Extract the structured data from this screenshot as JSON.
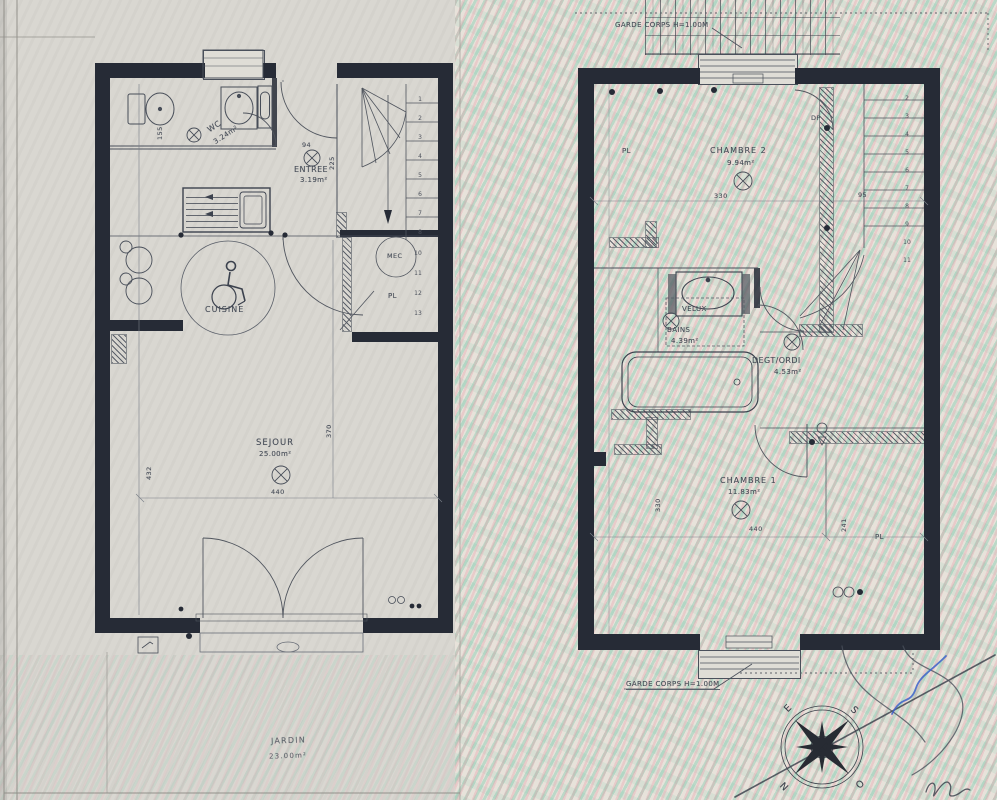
{
  "ground_floor": {
    "labels": {
      "wc": "WC",
      "wc_area": "3.24m²",
      "entree": "ENTREE",
      "entree_area": "3.19m²",
      "cuisine": "CUISINE",
      "sejour": "SEJOUR",
      "sejour_area": "25.00m²",
      "jardin": "JARDIN",
      "jardin_area": "23.00m²",
      "closet": "PL",
      "mec": "MEC"
    },
    "dimensions": {
      "width": "440",
      "depth": "432",
      "sejour_depth": "370",
      "entry_width": "94",
      "entry_depth": "225",
      "wc_width": "155"
    },
    "stair_numbers_upper": [
      "1",
      "2",
      "3",
      "4",
      "5",
      "6",
      "7",
      "8"
    ],
    "stair_numbers_lower": [
      "10",
      "11",
      "12",
      "13"
    ]
  },
  "first_floor": {
    "labels": {
      "chambre2": "CHAMBRE 2",
      "chambre2_area": "9.94m²",
      "closet_top": "PL",
      "door_dp": "DP",
      "velux": "VELUX",
      "bains": "BAINS",
      "bains_area": "4.39m²",
      "degagement": "DEGT/ORDI",
      "degagement_area": "4.53m²",
      "chambre1": "CHAMBRE 1",
      "chambre1_area": "11.83m²",
      "closet_right": "PL",
      "garde_corps_top": "GARDE CORPS H=1.00M",
      "garde_corps_bottom": "GARDE CORPS H=1.00M"
    },
    "dimensions": {
      "chambre2_width": "330",
      "stair_width": "95",
      "chambre1_width": "440",
      "closet_depth": "241",
      "chambre1_depth": "330"
    },
    "stair_numbers": [
      "2",
      "3",
      "4",
      "5",
      "6",
      "7",
      "8",
      "9",
      "10",
      "11"
    ]
  },
  "compass": {
    "north": "N",
    "east": "E",
    "south": "S",
    "west": "O"
  },
  "colors": {
    "wall": "#262b36",
    "ink": "#474d58",
    "moire_green": "#8fd2b9",
    "moire_pink": "#f0bfc6",
    "pen_blue": "#3b62c9",
    "paper": "#d9d7d1"
  }
}
